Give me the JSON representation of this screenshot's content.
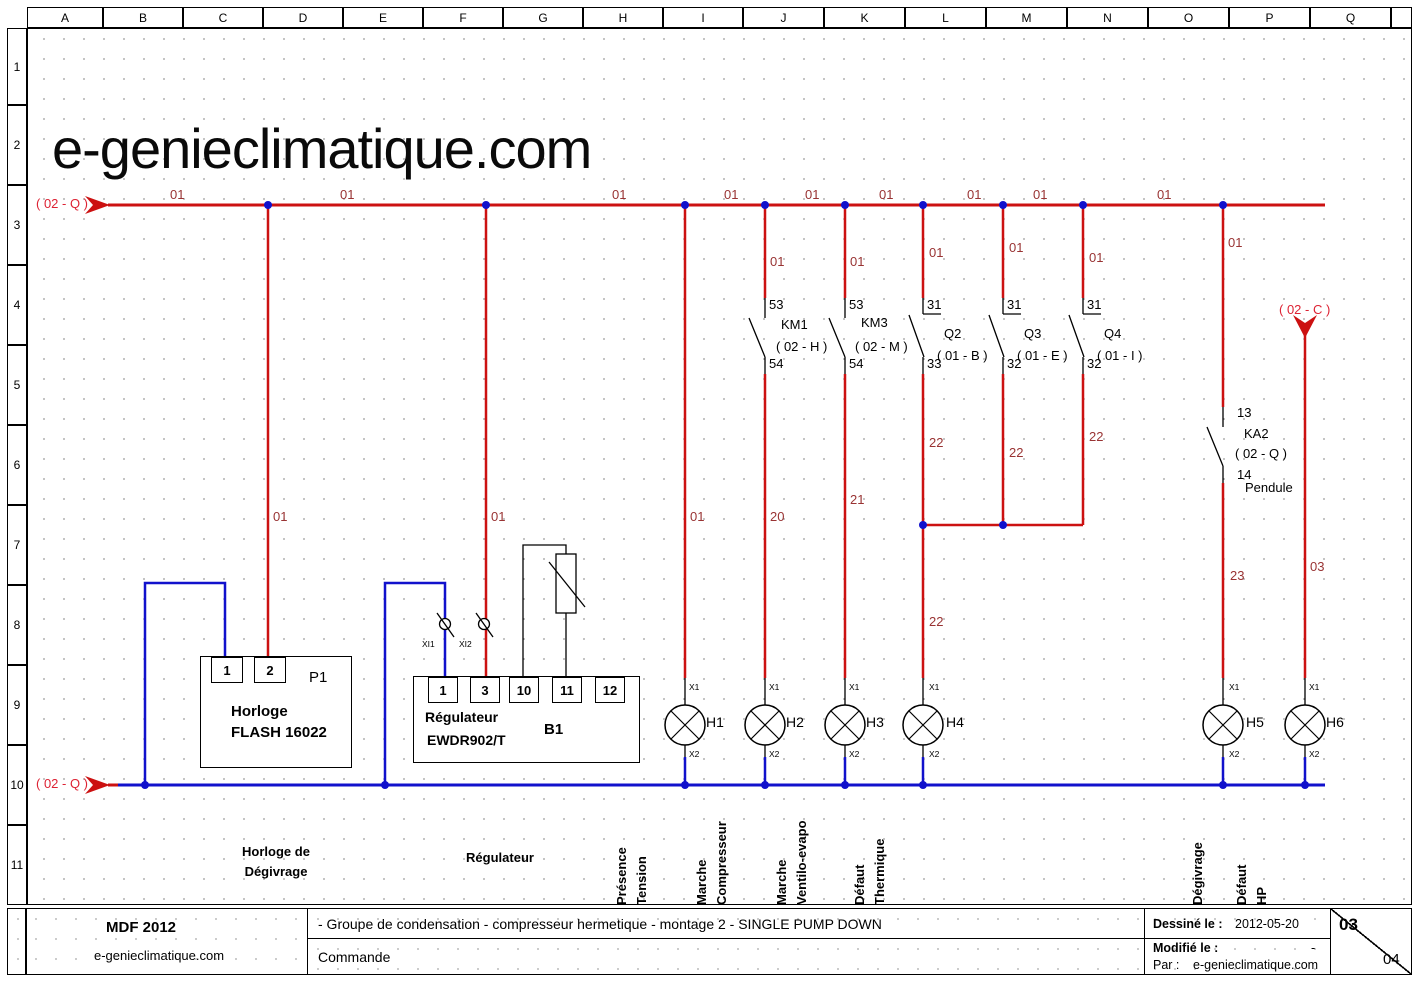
{
  "watermark": "e-genieclimatique.com",
  "colors": {
    "wire_red": "#cc1111",
    "wire_blue": "#1111cc",
    "label_red": "#993333",
    "ref_red": "#dd2233"
  },
  "grid": {
    "columns": [
      "A",
      "B",
      "C",
      "D",
      "E",
      "F",
      "G",
      "H",
      "I",
      "J",
      "K",
      "L",
      "M",
      "N",
      "O",
      "P",
      "Q",
      ""
    ],
    "rows": [
      "1",
      "2",
      "3",
      "4",
      "5",
      "6",
      "7",
      "8",
      "9",
      "10",
      "11"
    ]
  },
  "components": {
    "p1": {
      "ref": "P1",
      "line1": "Horloge",
      "line2": "FLASH 16022",
      "terminals": [
        "1",
        "2"
      ]
    },
    "regulator": {
      "line1": "Régulateur",
      "line2": "EWDR902/T",
      "sensor": "B1",
      "terminals": [
        "1",
        "3",
        "10",
        "11",
        "12"
      ]
    }
  },
  "schematic": {
    "labels": [
      {
        "name": "wire-01-seg1",
        "text": "01",
        "x": 170,
        "y": 188,
        "cls": "wire"
      },
      {
        "name": "wire-01-seg2",
        "text": "01",
        "x": 340,
        "y": 188,
        "cls": "wire"
      },
      {
        "name": "wire-01-seg3",
        "text": "01",
        "x": 612,
        "y": 188,
        "cls": "wire"
      },
      {
        "name": "wire-01-seg4",
        "text": "01",
        "x": 724,
        "y": 188,
        "cls": "wire"
      },
      {
        "name": "wire-01-seg5",
        "text": "01",
        "x": 805,
        "y": 188,
        "cls": "wire"
      },
      {
        "name": "wire-01-seg6",
        "text": "01",
        "x": 879,
        "y": 188,
        "cls": "wire"
      },
      {
        "name": "wire-01-seg7",
        "text": "01",
        "x": 967,
        "y": 188,
        "cls": "wire"
      },
      {
        "name": "wire-01-seg8",
        "text": "01",
        "x": 1033,
        "y": 188,
        "cls": "wire"
      },
      {
        "name": "wire-01-seg9",
        "text": "01",
        "x": 1157,
        "y": 188,
        "cls": "wire"
      },
      {
        "name": "wire-01-j",
        "text": "01",
        "x": 770,
        "y": 255,
        "cls": "wire"
      },
      {
        "name": "wire-01-k",
        "text": "01",
        "x": 850,
        "y": 255,
        "cls": "wire"
      },
      {
        "name": "wire-01-l",
        "text": "01",
        "x": 929,
        "y": 246,
        "cls": "wire"
      },
      {
        "name": "wire-01-m",
        "text": "01",
        "x": 1009,
        "y": 241,
        "cls": "wire"
      },
      {
        "name": "wire-01-n",
        "text": "01",
        "x": 1089,
        "y": 251,
        "cls": "wire"
      },
      {
        "name": "wire-01-p",
        "text": "01",
        "x": 1228,
        "y": 236,
        "cls": "wire"
      },
      {
        "name": "wire-01-d",
        "text": "01",
        "x": 273,
        "y": 510,
        "cls": "wire"
      },
      {
        "name": "wire-01-f",
        "text": "01",
        "x": 491,
        "y": 510,
        "cls": "wire"
      },
      {
        "name": "wire-01-i",
        "text": "01",
        "x": 690,
        "y": 510,
        "cls": "wire"
      },
      {
        "name": "wire-20",
        "text": "20",
        "x": 770,
        "y": 510,
        "cls": "wire"
      },
      {
        "name": "wire-21",
        "text": "21",
        "x": 850,
        "y": 493,
        "cls": "wire"
      },
      {
        "name": "wire-22-l-upper",
        "text": "22",
        "x": 929,
        "y": 436,
        "cls": "wire"
      },
      {
        "name": "wire-22-l-lower",
        "text": "22",
        "x": 929,
        "y": 615,
        "cls": "wire"
      },
      {
        "name": "wire-22-m",
        "text": "22",
        "x": 1009,
        "y": 446,
        "cls": "wire"
      },
      {
        "name": "wire-22-n",
        "text": "22",
        "x": 1089,
        "y": 430,
        "cls": "wire"
      },
      {
        "name": "wire-23",
        "text": "23",
        "x": 1230,
        "y": 569,
        "cls": "wire"
      },
      {
        "name": "wire-03",
        "text": "03",
        "x": 1310,
        "y": 560,
        "cls": "wire"
      },
      {
        "name": "ref-02q-top",
        "text": "( 02 - Q )",
        "x": 36,
        "y": 197,
        "cls": "ref"
      },
      {
        "name": "ref-02q-bottom",
        "text": "( 02 - Q )",
        "x": 36,
        "y": 777,
        "cls": "ref"
      },
      {
        "name": "ref-02c",
        "text": "( 02 - C )",
        "x": 1279,
        "y": 303,
        "cls": "ref"
      },
      {
        "name": "term-km1-53",
        "text": "53",
        "x": 769,
        "y": 298,
        "cls": "term-lbl"
      },
      {
        "name": "term-km1-54",
        "text": "54",
        "x": 769,
        "y": 357,
        "cls": "term-lbl"
      },
      {
        "name": "term-km3-53",
        "text": "53",
        "x": 849,
        "y": 298,
        "cls": "term-lbl"
      },
      {
        "name": "term-km3-54",
        "text": "54",
        "x": 849,
        "y": 357,
        "cls": "term-lbl"
      },
      {
        "name": "term-q2-31",
        "text": "31",
        "x": 927,
        "y": 298,
        "cls": "term-lbl"
      },
      {
        "name": "term-q2-33",
        "text": "33",
        "x": 927,
        "y": 357,
        "cls": "term-lbl"
      },
      {
        "name": "term-q3-31",
        "text": "31",
        "x": 1007,
        "y": 298,
        "cls": "term-lbl"
      },
      {
        "name": "term-q3-32",
        "text": "32",
        "x": 1007,
        "y": 357,
        "cls": "term-lbl"
      },
      {
        "name": "term-q4-31",
        "text": "31",
        "x": 1087,
        "y": 298,
        "cls": "term-lbl"
      },
      {
        "name": "term-q4-32",
        "text": "32",
        "x": 1087,
        "y": 357,
        "cls": "term-lbl"
      },
      {
        "name": "term-ka2-13",
        "text": "13",
        "x": 1237,
        "y": 406,
        "cls": "term-lbl"
      },
      {
        "name": "term-ka2-14",
        "text": "14",
        "x": 1237,
        "y": 468,
        "cls": "term-lbl"
      },
      {
        "name": "comp-km1",
        "text": "KM1",
        "x": 781,
        "y": 318,
        "cls": "comp"
      },
      {
        "name": "comp-km1-ref",
        "text": "( 02 - H )",
        "x": 776,
        "y": 340,
        "cls": "comp"
      },
      {
        "name": "comp-km3",
        "text": "KM3",
        "x": 861,
        "y": 316,
        "cls": "comp"
      },
      {
        "name": "comp-km3-ref",
        "text": "( 02 - M )",
        "x": 855,
        "y": 340,
        "cls": "comp"
      },
      {
        "name": "comp-q2",
        "text": "Q2",
        "x": 944,
        "y": 327,
        "cls": "comp"
      },
      {
        "name": "comp-q2-ref",
        "text": "( 01 - B )",
        "x": 937,
        "y": 349,
        "cls": "comp"
      },
      {
        "name": "comp-q3",
        "text": "Q3",
        "x": 1024,
        "y": 327,
        "cls": "comp"
      },
      {
        "name": "comp-q3-ref",
        "text": "( 01 - E )",
        "x": 1017,
        "y": 349,
        "cls": "comp"
      },
      {
        "name": "comp-q4",
        "text": "Q4",
        "x": 1104,
        "y": 327,
        "cls": "comp"
      },
      {
        "name": "comp-q4-ref",
        "text": "( 01 - I )",
        "x": 1097,
        "y": 349,
        "cls": "comp"
      },
      {
        "name": "comp-ka2",
        "text": "KA2",
        "x": 1244,
        "y": 427,
        "cls": "comp"
      },
      {
        "name": "comp-ka2-ref",
        "text": "( 02 - Q )",
        "x": 1235,
        "y": 447,
        "cls": "comp"
      },
      {
        "name": "comp-pendule",
        "text": "Pendule",
        "x": 1245,
        "y": 481,
        "cls": "comp"
      },
      {
        "name": "lamp-h1-label",
        "text": "H1",
        "x": 706,
        "y": 715,
        "cls": "lamp"
      },
      {
        "name": "lamp-h2-label",
        "text": "H2",
        "x": 786,
        "y": 715,
        "cls": "lamp"
      },
      {
        "name": "lamp-h3-label",
        "text": "H3",
        "x": 866,
        "y": 715,
        "cls": "lamp"
      },
      {
        "name": "lamp-h4-label",
        "text": "H4",
        "x": 946,
        "y": 715,
        "cls": "lamp"
      },
      {
        "name": "lamp-h5-label",
        "text": "H5",
        "x": 1246,
        "y": 715,
        "cls": "lamp"
      },
      {
        "name": "lamp-h6-label",
        "text": "H6",
        "x": 1326,
        "y": 715,
        "cls": "lamp"
      },
      {
        "name": "term-h1-x1",
        "text": "X1",
        "x": 689,
        "y": 683,
        "cls": "small"
      },
      {
        "name": "term-h2-x1",
        "text": "X1",
        "x": 769,
        "y": 683,
        "cls": "small"
      },
      {
        "name": "term-h3-x1",
        "text": "X1",
        "x": 849,
        "y": 683,
        "cls": "small"
      },
      {
        "name": "term-h4-x1",
        "text": "X1",
        "x": 929,
        "y": 683,
        "cls": "small"
      },
      {
        "name": "term-h5-x1",
        "text": "X1",
        "x": 1229,
        "y": 683,
        "cls": "small"
      },
      {
        "name": "term-h6-x1",
        "text": "X1",
        "x": 1309,
        "y": 683,
        "cls": "small"
      },
      {
        "name": "term-h1-x2",
        "text": "X2",
        "x": 689,
        "y": 750,
        "cls": "small"
      },
      {
        "name": "term-h2-x2",
        "text": "X2",
        "x": 769,
        "y": 750,
        "cls": "small"
      },
      {
        "name": "term-h3-x2",
        "text": "X2",
        "x": 849,
        "y": 750,
        "cls": "small"
      },
      {
        "name": "term-h4-x2",
        "text": "X2",
        "x": 929,
        "y": 750,
        "cls": "small"
      },
      {
        "name": "term-h5-x2",
        "text": "X2",
        "x": 1229,
        "y": 750,
        "cls": "small"
      },
      {
        "name": "term-h6-x2",
        "text": "X2",
        "x": 1309,
        "y": 750,
        "cls": "small"
      },
      {
        "name": "conn-xi1",
        "text": "XI1",
        "x": 422,
        "y": 640,
        "cls": "small"
      },
      {
        "name": "conn-xi2",
        "text": "XI2",
        "x": 459,
        "y": 640,
        "cls": "small"
      },
      {
        "name": "func-horloge-line1",
        "text": "Horloge de",
        "x": 276,
        "y": 845,
        "cls": "func mid"
      },
      {
        "name": "func-horloge-line2",
        "text": "Dégivrage",
        "x": 276,
        "y": 865,
        "cls": "func mid"
      },
      {
        "name": "func-regulateur",
        "text": "Régulateur",
        "x": 500,
        "y": 851,
        "cls": "func mid"
      }
    ]
  },
  "function_labels": [
    {
      "name": "vlabel-presence-tension",
      "lines": [
        "Présence",
        "Tension"
      ],
      "x": 685
    },
    {
      "name": "vlabel-marche-compresseur",
      "lines": [
        "Marche",
        "Compresseur"
      ],
      "x": 765
    },
    {
      "name": "vlabel-marche-ventilo-evapo",
      "lines": [
        "Marche",
        "Ventilo-evapo"
      ],
      "x": 845
    },
    {
      "name": "vlabel-defaut-thermique",
      "lines": [
        "Défaut",
        "Thermique"
      ],
      "x": 923
    },
    {
      "name": "vlabel-degivrage",
      "lines": [
        "Dégivrage"
      ],
      "x": 1225
    },
    {
      "name": "vlabel-defaut-hp",
      "lines": [
        "Défaut",
        "HP"
      ],
      "x": 1305
    }
  ],
  "title_block": {
    "company": "MDF 2012",
    "website": "e-genieclimatique.com",
    "description": "- Groupe de condensation - compresseur hermetique - montage 2 - SINGLE PUMP DOWN",
    "subtitle": "Commande",
    "drawn_label": "Dessiné le :",
    "drawn_value": "2012-05-20",
    "modified_label": "Modifié le :",
    "modified_value": "-",
    "by_label": "Par :",
    "by_value": "e-genieclimatique.com",
    "page": "03",
    "total": "04"
  }
}
